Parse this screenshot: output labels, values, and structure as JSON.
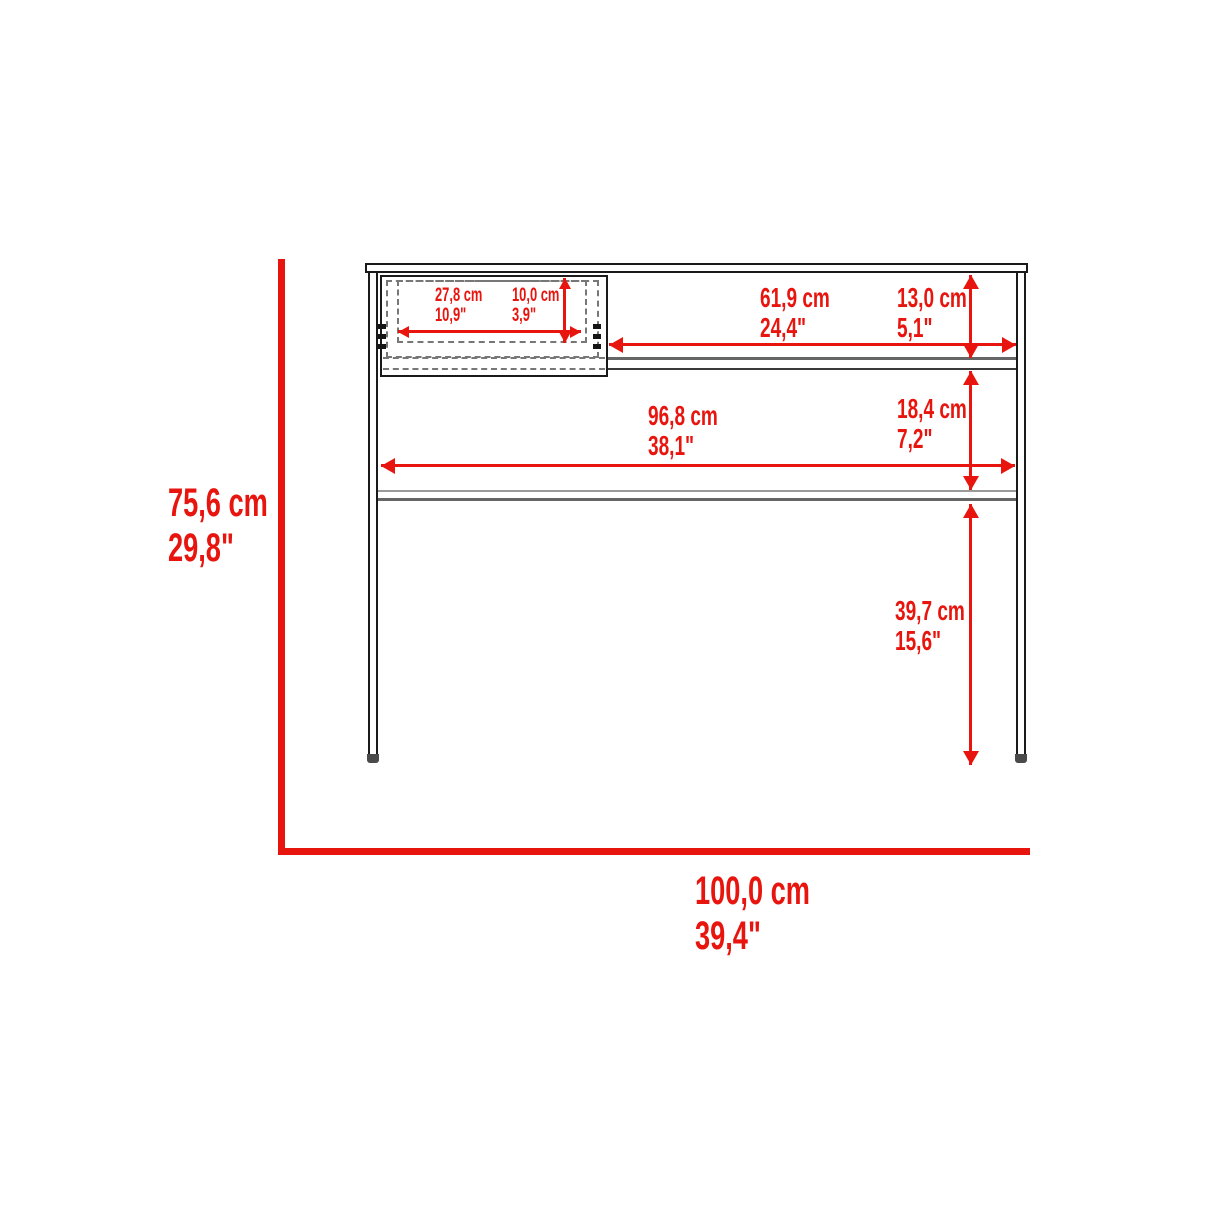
{
  "title": "Desk dimension diagram",
  "colors": {
    "dimension": "#e8150f",
    "line": "#1a1a1a"
  },
  "dimensions": {
    "overall_height": {
      "cm": "75,6 cm",
      "in": "29,8\""
    },
    "overall_width": {
      "cm": "100,0 cm",
      "in": "39,4\""
    },
    "drawer_width": {
      "cm": "27,8 cm",
      "in": "10,9\""
    },
    "drawer_height": {
      "cm": "10,0 cm",
      "in": "3,9\""
    },
    "open_shelf_width": {
      "cm": "61,9 cm",
      "in": "24,4\""
    },
    "top_clearance": {
      "cm": "13,0 cm",
      "in": "5,1\""
    },
    "inner_width": {
      "cm": "96,8 cm",
      "in": "38,1\""
    },
    "shelf_clearance": {
      "cm": "18,4 cm",
      "in": "7,2\""
    },
    "leg_clearance": {
      "cm": "39,7 cm",
      "in": "15,6\""
    }
  }
}
